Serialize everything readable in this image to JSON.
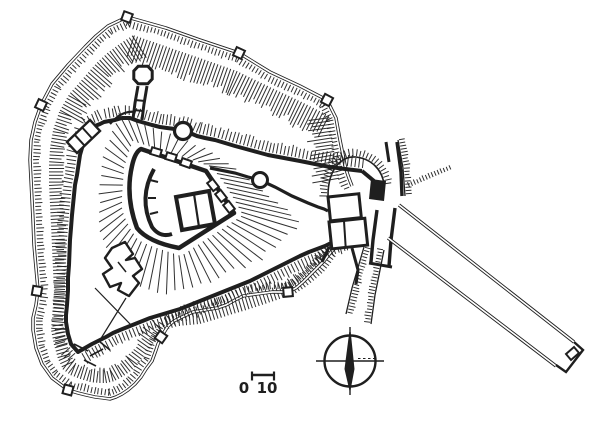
{
  "colors": {
    "background": "#ffffff",
    "ink": "#1f1f1f"
  },
  "scale_bar": {
    "start_label": "0",
    "end_label": "10"
  },
  "icons": {
    "compass": "compass-rose"
  }
}
